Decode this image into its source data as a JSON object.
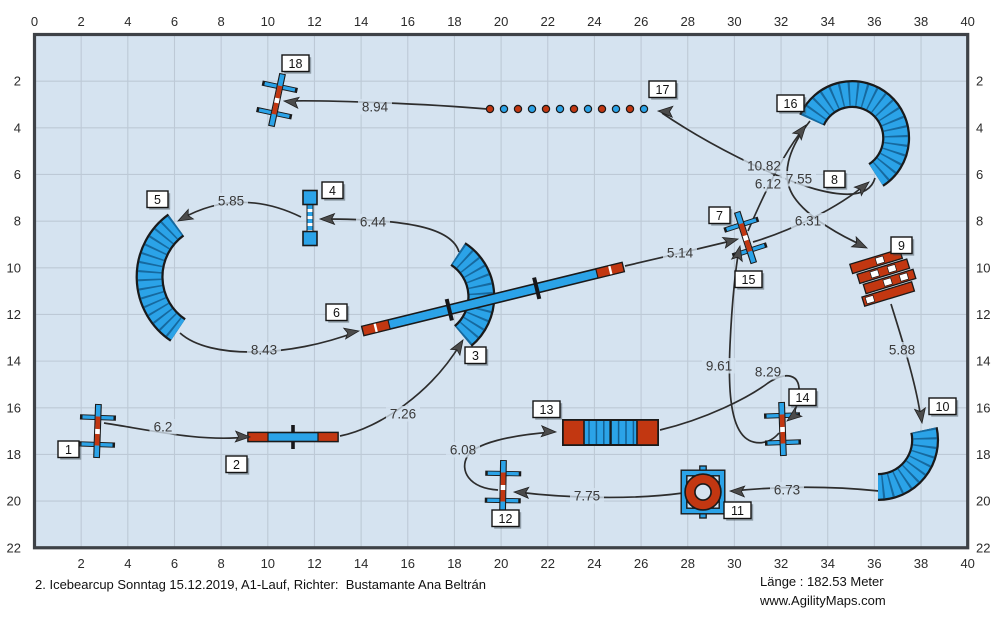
{
  "footer": {
    "title": "2. Icebearcup Sonntag 15.12.2019, A1-Lauf, Richter:  Bustamante Ana Beltrán",
    "length": "Länge : 182.53 Meter",
    "website": "www.AgilityMaps.com"
  },
  "colors": {
    "field_bg": "#D5E3F0",
    "grid": "#BDC9D6",
    "border": "#3E4247",
    "path": "#2D2D2D",
    "arrow": "#4B4B4B",
    "blue": "#2BA3E8",
    "blue_dark": "#135F92",
    "red": "#C23711",
    "outline": "#1A1A1A",
    "label_text": "#3A3A3A",
    "axis_text": "#2B2B2B",
    "box_bg": "#FFFFFF",
    "box_border": "#141414",
    "box_shadow": "rgba(60,70,80,0.45)"
  },
  "field": {
    "origin_x": 34.5,
    "origin_y": 34.5,
    "px_per_m": 23.33,
    "width_m": 40,
    "height_m": 22,
    "grid_step_m": 2
  },
  "axes": {
    "top": [
      0,
      2,
      4,
      6,
      8,
      10,
      12,
      14,
      16,
      18,
      20,
      22,
      24,
      26,
      28,
      30,
      32,
      34,
      36,
      38,
      40
    ],
    "bottom": [
      2,
      4,
      6,
      8,
      10,
      12,
      14,
      16,
      18,
      20,
      22,
      24,
      26,
      28,
      30,
      32,
      34,
      36,
      38,
      40
    ],
    "left": [
      2,
      4,
      6,
      8,
      10,
      12,
      14,
      16,
      18,
      20,
      22
    ],
    "right": [
      2,
      4,
      6,
      8,
      10,
      12,
      14,
      16,
      18,
      20,
      22
    ]
  },
  "obstacles": [
    {
      "type": "jump",
      "name": "jump-1",
      "cx": 97.5,
      "cy": 431,
      "rot": 92
    },
    {
      "type": "seesaw",
      "name": "seesaw-2",
      "cx": 293,
      "cy": 437,
      "rot": 0
    },
    {
      "type": "tunnel",
      "name": "curved-tunnel-3",
      "d": "M458,254 A51,51 0 0 1 463,336"
    },
    {
      "type": "panel",
      "name": "panel-jump-4",
      "cx": 310,
      "cy": 218,
      "rot": 90
    },
    {
      "type": "tunnel",
      "name": "curved-tunnel-5",
      "d": "M176,225 A64,64 0 0 0 178,330"
    },
    {
      "type": "dogwalk",
      "name": "dogwalk-6",
      "cx": 493,
      "cy": 299,
      "rot": -13.8
    },
    {
      "type": "jump",
      "name": "jump-7-15",
      "cx": 745.5,
      "cy": 237.5,
      "rot": 72
    },
    {
      "type": "tunnel",
      "name": "curved-tunnel-8-16",
      "d": "M812,120 A44,44 0 1 1 876,175"
    },
    {
      "type": "wall",
      "name": "wall-9",
      "cx": 884,
      "cy": 277,
      "rot": -17
    },
    {
      "type": "tunnel",
      "name": "curved-tunnel-10",
      "d": "M924,430 A47,47 0 0 1 878,487"
    },
    {
      "type": "tire",
      "name": "tire-jump-11",
      "cx": 703,
      "cy": 492
    },
    {
      "type": "jump",
      "name": "jump-12",
      "cx": 503,
      "cy": 487,
      "rot": 91
    },
    {
      "type": "tunnel_straight",
      "name": "straight-tunnel-13",
      "x": 563,
      "y": 420,
      "w": 95,
      "h": 25
    },
    {
      "type": "jump",
      "name": "jump-14",
      "cx": 782.5,
      "cy": 429,
      "rot": 88
    },
    {
      "type": "weaves",
      "name": "weave-poles-17",
      "x": 490,
      "y": 109,
      "count": 12,
      "gap": 14,
      "first_color": "red"
    },
    {
      "type": "jump",
      "name": "jump-18",
      "cx": 277,
      "cy": 100,
      "rot": 102
    }
  ],
  "number_labels": [
    {
      "n": "1",
      "x": 58,
      "y": 441
    },
    {
      "n": "2",
      "x": 226,
      "y": 456
    },
    {
      "n": "3",
      "x": 465,
      "y": 347
    },
    {
      "n": "4",
      "x": 322,
      "y": 182
    },
    {
      "n": "5",
      "x": 147,
      "y": 191
    },
    {
      "n": "6",
      "x": 326,
      "y": 304
    },
    {
      "n": "7",
      "x": 709,
      "y": 207
    },
    {
      "n": "8",
      "x": 824,
      "y": 171
    },
    {
      "n": "9",
      "x": 891,
      "y": 237
    },
    {
      "n": "10",
      "x": 929,
      "y": 398
    },
    {
      "n": "11",
      "x": 724,
      "y": 502
    },
    {
      "n": "12",
      "x": 492,
      "y": 510
    },
    {
      "n": "13",
      "x": 533,
      "y": 401
    },
    {
      "n": "14",
      "x": 789,
      "y": 389
    },
    {
      "n": "15",
      "x": 735,
      "y": 271
    },
    {
      "n": "16",
      "x": 777,
      "y": 95
    },
    {
      "n": "17",
      "x": 649,
      "y": 81
    },
    {
      "n": "18",
      "x": 282,
      "y": 55
    }
  ],
  "segments": [
    {
      "from": "1",
      "to": "2",
      "label": "6.2",
      "lx": 163,
      "ly": 427,
      "d": "M104,423 C150,430 200,442 247,437",
      "ax": 250,
      "ay": 437,
      "aa": 2
    },
    {
      "from": "2",
      "to": "3",
      "label": "7.26",
      "lx": 403,
      "ly": 414,
      "d": "M340,436 C380,428 432,392 461,343",
      "ax": 463,
      "ay": 340,
      "aa": -58
    },
    {
      "from": "3",
      "to": "4",
      "label": "6.44",
      "lx": 373,
      "ly": 222,
      "d": "M459,252 C452,228 408,219 323,219",
      "ax": 320,
      "ay": 219,
      "aa": 180
    },
    {
      "from": "4",
      "to": "5",
      "label": "5.85",
      "lx": 231,
      "ly": 201,
      "d": "M301,217 C262,198 222,196 181,219",
      "ax": 178,
      "ay": 221,
      "aa": 152
    },
    {
      "from": "5",
      "to": "6",
      "label": "8.43",
      "lx": 264,
      "ly": 350,
      "d": "M180,333 C210,360 290,357 356,332",
      "ax": 359,
      "ay": 331,
      "aa": -10
    },
    {
      "from": "6",
      "to": "7",
      "label": "5.14",
      "lx": 680,
      "ly": 253,
      "d": "M625,266 C660,258 702,248 735,240",
      "ax": 738,
      "ay": 239,
      "aa": -15
    },
    {
      "from": "7",
      "to": "8",
      "label": "6.31",
      "lx": 808,
      "ly": 221,
      "d": "M753,242 C790,231 838,208 866,184",
      "ax": 869,
      "ay": 182,
      "aa": -40
    },
    {
      "from": "8",
      "to": "9",
      "label": "7.55",
      "lx": 799,
      "ly": 179,
      "d": "M810,121 C788,149 780,176 794,197 C808,218 843,237 864,246",
      "ax": 867,
      "ay": 248,
      "aa": 25
    },
    {
      "from": "9",
      "to": "10",
      "label": "5.88",
      "lx": 902,
      "ly": 350,
      "d": "M891,304 C899,330 917,385 921,420",
      "ax": 922,
      "ay": 423,
      "aa": 82
    },
    {
      "from": "10",
      "to": "11",
      "label": "6.73",
      "lx": 787,
      "ly": 490,
      "d": "M879,491 C830,486 782,486 733,491",
      "ax": 730,
      "ay": 491,
      "aa": 182
    },
    {
      "from": "11",
      "to": "12",
      "label": "7.75",
      "lx": 587,
      "ly": 496,
      "d": "M683,493 C632,500 565,498 517,492",
      "ax": 514,
      "ay": 492,
      "aa": 183
    },
    {
      "from": "12",
      "to": "13",
      "label": "6.08",
      "lx": 463,
      "ly": 450,
      "d": "M498,490 C468,488 460,470 467,457 C474,443 512,435 553,432",
      "ax": 556,
      "ay": 432,
      "aa": 3
    },
    {
      "from": "13",
      "to": "14",
      "label": "8.29",
      "lx": 768,
      "ly": 372,
      "d": "M660,430 C706,419 748,398 768,383 C786,371 800,374 799,392 C798,408 793,415 789,419",
      "ax": 787,
      "ay": 421,
      "aa": 142
    },
    {
      "from": "14",
      "to": "15",
      "label": "9.61",
      "lx": 719,
      "ly": 366,
      "d": "M779,433 C768,446 750,446 741,433 C731,419 728,390 730,345 C732,300 736,265 739,250",
      "ax": 740,
      "ay": 246,
      "aa": -78
    },
    {
      "from": "15",
      "to": "16",
      "label": "6.12",
      "lx": 768,
      "ly": 184,
      "d": "M748,231 C757,210 780,157 804,128",
      "ax": 806,
      "ay": 125,
      "aa": -52
    },
    {
      "from": "16",
      "to": "17",
      "label": "10.82",
      "lx": 764,
      "ly": 166,
      "d": "M875,178 C870,196 848,198 815,189 C770,176 706,143 662,113",
      "ax": 658,
      "ay": 111,
      "aa": 183
    },
    {
      "from": "17",
      "to": "18",
      "label": "8.94",
      "lx": 375,
      "ly": 107,
      "d": "M487,109 C430,104 330,100 287,101",
      "ax": 284,
      "ay": 101,
      "aa": 187
    }
  ]
}
